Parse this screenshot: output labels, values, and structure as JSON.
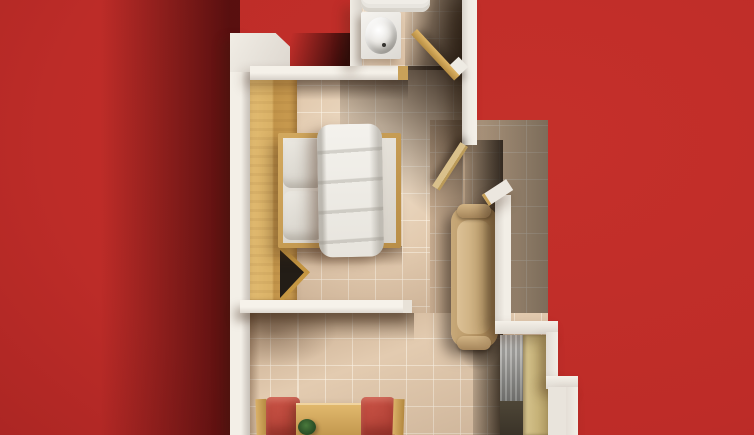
{
  "canvas": {
    "width": 754,
    "height": 435
  },
  "scene": {
    "type": "top-down 3d floor plan render of a hotel room, no text visible",
    "background": "bright red ground with soft building shadow cast to the left",
    "rooms": [
      {
        "name": "bathroom",
        "position": "top",
        "contents": [
          "bathtub-edge",
          "oval-sink",
          "open-wood-door"
        ]
      },
      {
        "name": "bedroom",
        "position": "center",
        "contents": [
          "wardrobe-with-open-v-doors",
          "double-bed-with-white-duvet-and-two-pillows"
        ]
      },
      {
        "name": "entry-hall",
        "position": "right",
        "contents": [
          "open-entry-door",
          "tan-armchair",
          "gray-curtain",
          "khaki-entry-panel",
          "stepped-outer-wall"
        ]
      },
      {
        "name": "sitting-area",
        "position": "bottom",
        "contents": [
          "red-armchair-left",
          "wood-coffee-table-with-plant",
          "red-armchair-right"
        ]
      }
    ],
    "floor": "beige ceramic tiles with light grout grid, warm light pooling at center, deep shadows in top-right and along right hall"
  },
  "palette": {
    "bg-red": "#bd2c28",
    "bg-red-bright": "#c5302a",
    "bg-red-dark": "#821b1c",
    "wall-light": "#f2eee6",
    "wall-dark": "#cfc9c1",
    "floor-tile": "#e2cbb1",
    "wood-light": "#e3bc72",
    "wood-mid": "#c9a159",
    "duvet": "#e7e4dd",
    "pillow": "#cfcbc2",
    "ceramic": "#f6f4f0",
    "chair-red": "#a93c32",
    "armchair-tan": "#c7a878",
    "curtain-gray": "#8f8e8a",
    "door-khaki": "#c6b278",
    "plant-green": "#2f5429",
    "recess-dark": "#231d16"
  }
}
